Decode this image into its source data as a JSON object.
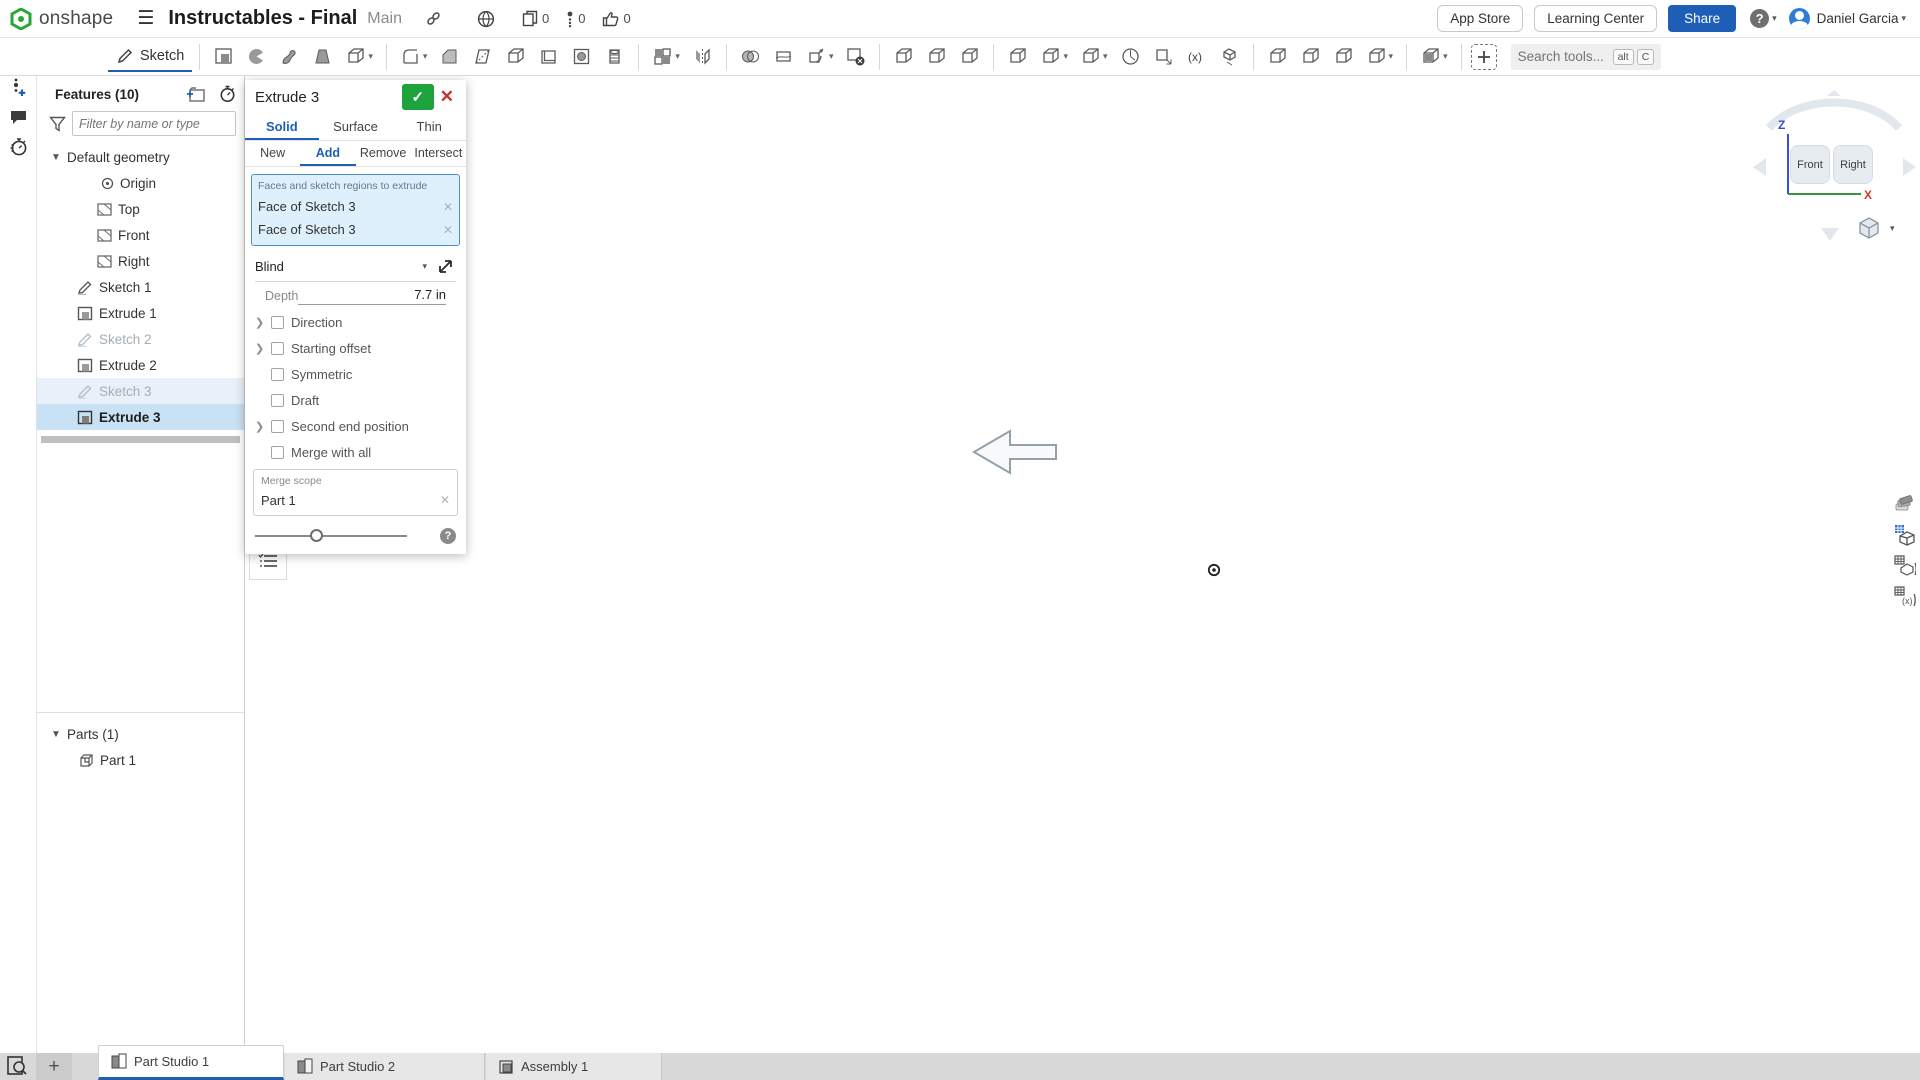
{
  "topbar": {
    "logo_text": "onshape",
    "document_title": "Instructables - Final",
    "workspace_name": "Main",
    "counts": {
      "copies": "0",
      "issues": "0",
      "likes": "0"
    },
    "app_store": "App Store",
    "learning_center": "Learning Center",
    "share": "Share",
    "user_name": "Daniel Garcia"
  },
  "toolbar": {
    "sketch_label": "Sketch",
    "search_placeholder": "Search tools...",
    "shortcut_alt": "alt",
    "shortcut_c": "C",
    "groups": [
      {
        "tools": [
          {
            "id": "extrude",
            "label": "Extrude"
          },
          {
            "id": "revolve",
            "label": "Revolve"
          },
          {
            "id": "sweep",
            "label": "Sweep"
          },
          {
            "id": "loft",
            "label": "Loft"
          },
          {
            "id": "thicken",
            "label": "Thicken",
            "caret": true
          }
        ]
      },
      {
        "tools": [
          {
            "id": "fillet",
            "label": "Fillet",
            "caret": true
          },
          {
            "id": "chamfer",
            "label": "Chamfer"
          },
          {
            "id": "draft",
            "label": "Draft"
          },
          {
            "id": "rib",
            "label": "Rib"
          },
          {
            "id": "shell",
            "label": "Shell"
          },
          {
            "id": "hole",
            "label": "Hole"
          },
          {
            "id": "thread",
            "label": "Thread"
          }
        ]
      },
      {
        "tools": [
          {
            "id": "linear-pattern",
            "label": "Linear pattern",
            "caret": true
          },
          {
            "id": "mirror",
            "label": "Mirror"
          }
        ]
      },
      {
        "tools": [
          {
            "id": "boolean",
            "label": "Boolean"
          },
          {
            "id": "split",
            "label": "Split"
          },
          {
            "id": "transform",
            "label": "Transform",
            "caret": true
          },
          {
            "id": "delete-part",
            "label": "Delete part"
          }
        ]
      },
      {
        "tools": [
          {
            "id": "modify-fillet",
            "label": "Modify fillet"
          },
          {
            "id": "move-face",
            "label": "Move face"
          },
          {
            "id": "replace-face",
            "label": "Replace face"
          }
        ]
      },
      {
        "tools": [
          {
            "id": "plane",
            "label": "Plane"
          },
          {
            "id": "offset-surface",
            "label": "Offset surface",
            "caret": true
          },
          {
            "id": "helix",
            "label": "Helix",
            "caret": true
          },
          {
            "id": "circular-pattern",
            "label": "Circular pattern"
          },
          {
            "id": "derived",
            "label": "Derived"
          },
          {
            "id": "variable",
            "label": "Variable"
          },
          {
            "id": "frame",
            "label": "Frame"
          }
        ]
      },
      {
        "tools": [
          {
            "id": "sheet-metal-model",
            "label": "Sheet metal model"
          },
          {
            "id": "flange",
            "label": "Flange"
          },
          {
            "id": "enclose",
            "label": "Enclose"
          },
          {
            "id": "sheet-metal-table",
            "label": "Sheet metal table",
            "caret": true
          }
        ]
      },
      {
        "tools": [
          {
            "id": "named-views",
            "label": "Named views",
            "caret": true
          }
        ]
      },
      {
        "tools": [
          {
            "id": "custom-feature",
            "label": "Insert custom feature"
          }
        ]
      }
    ]
  },
  "features_panel": {
    "header": "Features (10)",
    "filter_placeholder": "Filter by name or type",
    "tree": [
      {
        "label": "Default geometry"
      },
      {
        "label": "Origin"
      },
      {
        "label": "Top"
      },
      {
        "label": "Front"
      },
      {
        "label": "Right"
      },
      {
        "label": "Sketch 1"
      },
      {
        "label": "Extrude 1"
      },
      {
        "label": "Sketch 2"
      },
      {
        "label": "Extrude 2"
      },
      {
        "label": "Sketch 3"
      },
      {
        "label": "Extrude 3"
      }
    ],
    "parts_header": "Parts (1)",
    "parts": [
      {
        "label": "Part 1"
      }
    ]
  },
  "dialog": {
    "title": "Extrude 3",
    "type_tabs": [
      {
        "label": "Solid"
      },
      {
        "label": "Surface"
      },
      {
        "label": "Thin"
      }
    ],
    "mode_tabs": [
      {
        "label": "New"
      },
      {
        "label": "Add"
      },
      {
        "label": "Remove"
      },
      {
        "label": "Intersect"
      }
    ],
    "selection_label": "Faces and sketch regions to extrude",
    "selections": [
      {
        "label": "Face of Sketch 3"
      },
      {
        "label": "Face of Sketch 3"
      }
    ],
    "end_condition": "Blind",
    "depth_label": "Depth",
    "depth_value": "7.7 in",
    "options": [
      {
        "label": "Direction"
      },
      {
        "label": "Starting offset"
      },
      {
        "label": "Symmetric"
      },
      {
        "label": "Draft"
      },
      {
        "label": "Second end position"
      },
      {
        "label": "Merge with all"
      }
    ],
    "merge_scope_label": "Merge scope",
    "merge_scope_value": "Part 1"
  },
  "viewport": {
    "plane_label": "Right",
    "view_cube": {
      "front": "Front",
      "right": "Right",
      "z_axis": "Z",
      "x_axis": "X"
    },
    "colors": {
      "part_right": "#8cb9da",
      "part_left_gradient_top": "#dcecf8",
      "part_left_gradient_bottom": "#a2c8e3",
      "mid_column": "#57707f",
      "slot": "#41556a",
      "selection_highlight": "#f1a22f",
      "plane_label_blue": "#3b5ec9",
      "accent_blue": "#1f5eb7",
      "confirm_green": "#1ea33c",
      "cancel_red": "#c2342b"
    }
  },
  "tabs_bar": {
    "tabs": [
      {
        "label": "Part Studio 1",
        "active": true
      },
      {
        "label": "Part Studio 2"
      },
      {
        "label": "Assembly 1"
      }
    ]
  }
}
